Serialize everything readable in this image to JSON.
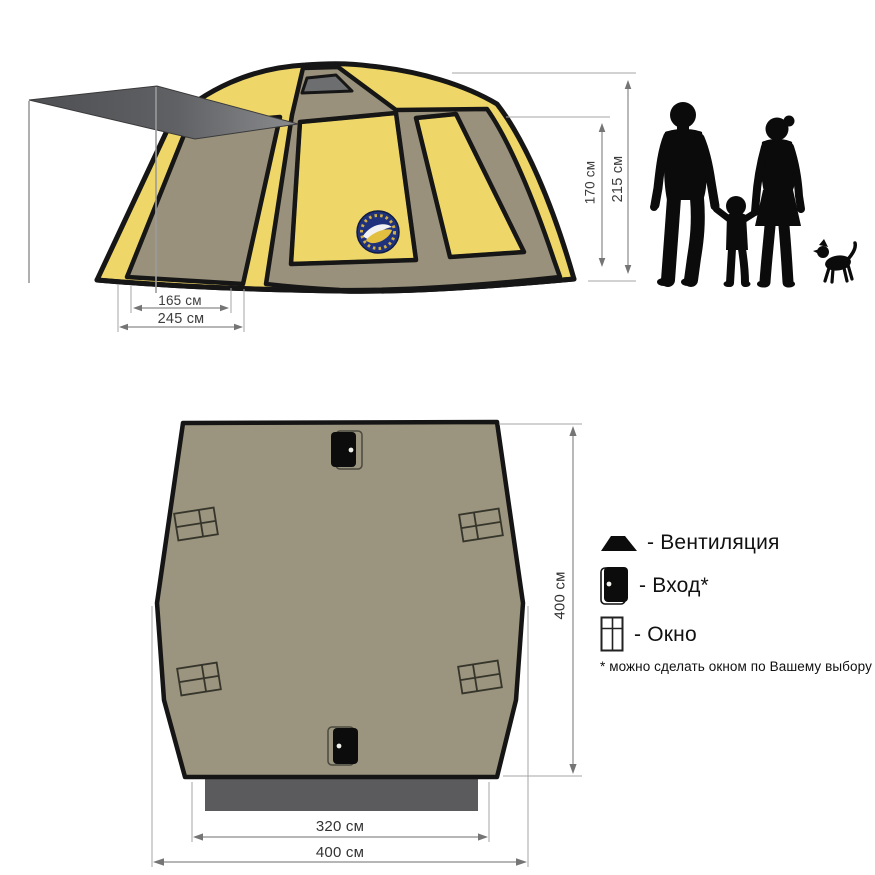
{
  "title": "Tent dimensions diagram",
  "colors": {
    "tent_yellow": "#eed768",
    "tent_khaki": "#99917b",
    "plan_khaki": "#9b947e",
    "outline_black": "#161616",
    "awning_dark": "#515255",
    "awning_light": "#8b8c8e",
    "vent_gray": "#6d6e70",
    "porch_gray": "#5b5b5d",
    "dim_line": "#8a8a8a",
    "dim_text": "#3d3d3d",
    "silhouette_black": "#0b0b0b",
    "logo_navy": "#20327c",
    "logo_yellow": "#e2bf3f"
  },
  "side_view": {
    "dim_inner_width": "165 см",
    "dim_awning_width": "245 см",
    "dim_wall_height": "170 см",
    "dim_total_height": "215 см"
  },
  "floor_plan": {
    "dim_depth": "400 см",
    "dim_front_width": "320 см",
    "dim_total_width": "400 см"
  },
  "legend": {
    "items": [
      {
        "id": "ventilation",
        "icon": "vent-icon",
        "label": "- Вентиляция"
      },
      {
        "id": "entrance",
        "icon": "door-icon",
        "label": "- Вход*"
      },
      {
        "id": "window",
        "icon": "window-icon",
        "label": "- Окно"
      }
    ],
    "footnote": "* можно сделать окном по Вашему выбору"
  }
}
